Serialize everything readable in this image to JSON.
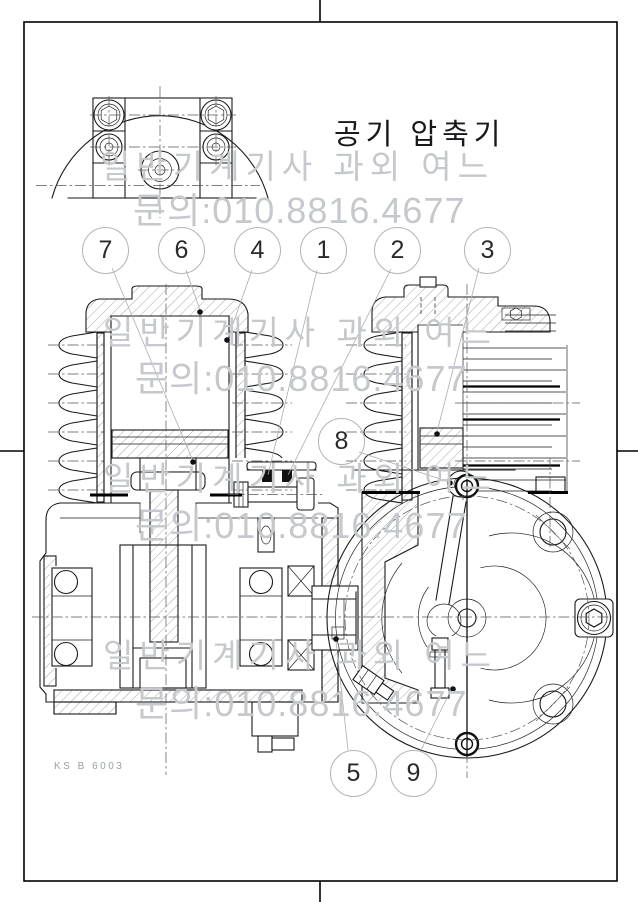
{
  "drawing": {
    "title": "공기 압축기",
    "standard_code": "KS B 6003"
  },
  "watermark": {
    "line1": "일반기계기사 과외 여느",
    "line2": "문의:010.8816.4677"
  },
  "balloons": [
    {
      "num": "7"
    },
    {
      "num": "6"
    },
    {
      "num": "4"
    },
    {
      "num": "1"
    },
    {
      "num": "2"
    },
    {
      "num": "3"
    },
    {
      "num": "8"
    },
    {
      "num": "5"
    },
    {
      "num": "9"
    }
  ],
  "colors": {
    "line": "#1a1a1a",
    "watermark": "#c5c8cc",
    "balloon_outline": "#b3b3b3",
    "leader_dot": "#111111"
  }
}
